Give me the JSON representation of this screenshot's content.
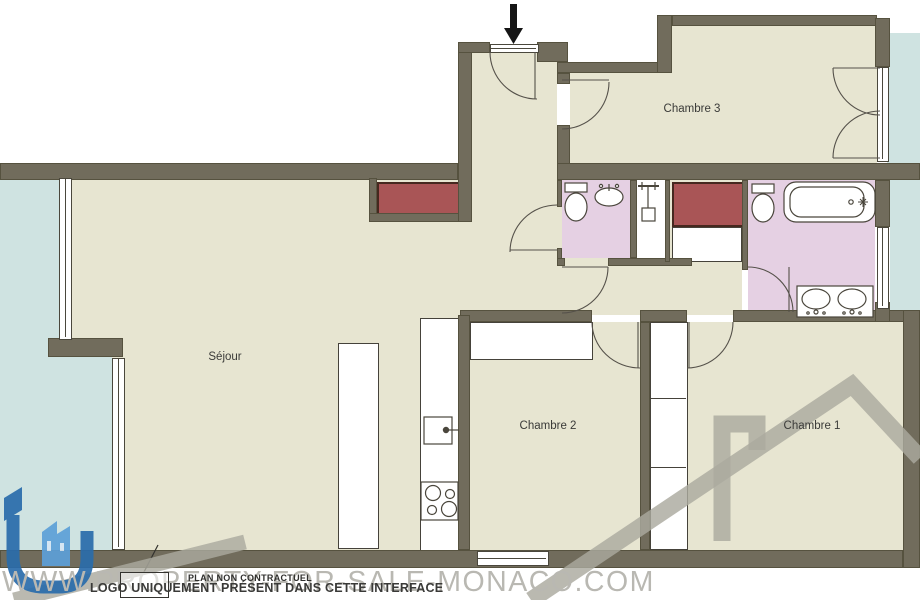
{
  "plan": {
    "title": "apartment floor plan",
    "rooms": {
      "sejour": "Séjour",
      "chambre1": "Chambre 1",
      "chambre2": "Chambre 2",
      "chambre3": "Chambre 3"
    },
    "footer": {
      "disclaimer": "PLAN NON CONTRACTUEL",
      "logo_note": "LOGO UNIQUEMENT PRÉSENT DANS CETTE INTERFACE"
    },
    "watermark_url": "WWW.PROPERTY-FOR-SALE-MONACO.COM",
    "icons": {
      "entrance_arrow": "black down arrow marking the entrance door",
      "toilet": "toilet bowl with tank (WC and master bathroom)",
      "corner_sink": "small hand basin in WC",
      "shower_head": "wall shower fixture in shower room",
      "bathtub": "bathtub in master bathroom",
      "double_sink_vanity": "two-basin vanity in master bathroom",
      "kitchen_sink": "square kitchen sink with faucet",
      "stove": "four-burner hob",
      "roof_logo_watermark": "gray roofline-with-chimney agency logo",
      "id_logo": "blue stylized iD agency logo"
    },
    "colors": {
      "wall": "#716c5c",
      "floor": "#e7e5d1",
      "bathroom_floor": "#e5d0e3",
      "closet_red": "#a95556",
      "balcony_blue": "#cfe3e1",
      "watermark_gray": "#aba99f",
      "watermark_text": "#b9b8b2",
      "logo_blue_dark": "#2a6cab",
      "logo_blue_light": "#5da0d8"
    }
  }
}
